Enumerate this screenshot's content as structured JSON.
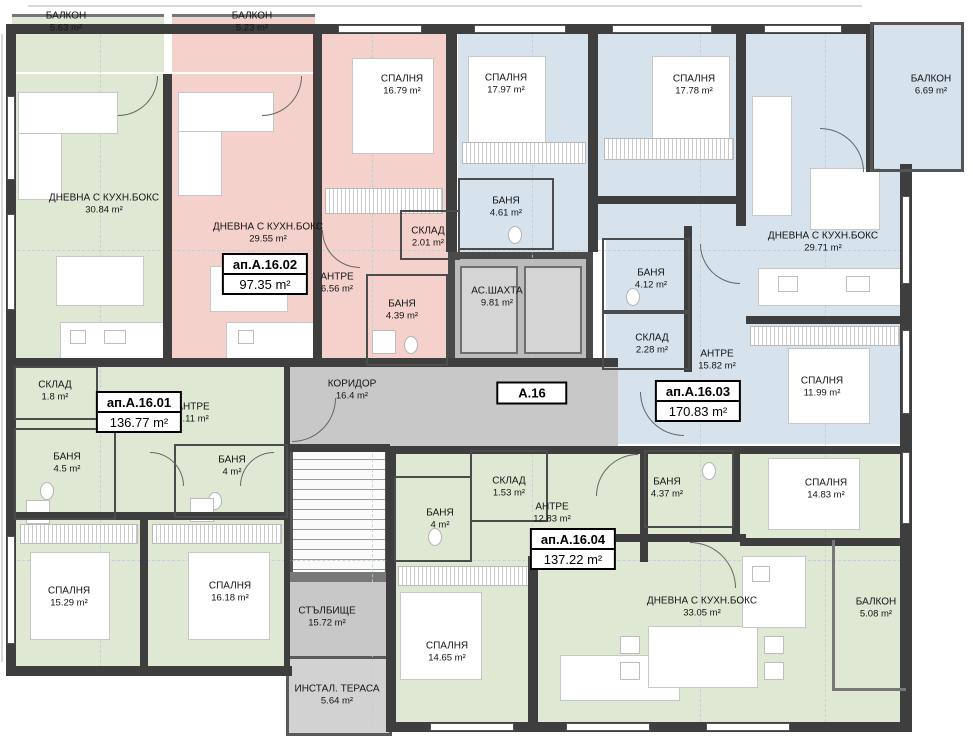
{
  "block": {
    "label": "А.16"
  },
  "units": [
    {
      "id": "ап.А.16.01",
      "area": "136.77 m²"
    },
    {
      "id": "ап.А.16.02",
      "area": "97.35 m²"
    },
    {
      "id": "ап.А.16.03",
      "area": "170.83 m²"
    },
    {
      "id": "ап.А.16.04",
      "area": "137.22 m²"
    }
  ],
  "rooms": [
    {
      "name": "БАЛКОН",
      "area": "5.63 m²",
      "unit": "ап.А.16.01"
    },
    {
      "name": "БАЛКОН",
      "area": "5.23 m²",
      "unit": "ап.А.16.02"
    },
    {
      "name": "ДНЕВНА С КУХН.БОКС",
      "area": "30.84 m²",
      "unit": "ап.А.16.01"
    },
    {
      "name": "ДНЕВНА С КУХН.БОКС",
      "area": "29.55 m²",
      "unit": "ап.А.16.02"
    },
    {
      "name": "СПАЛНЯ",
      "area": "16.79 m²",
      "unit": "ап.А.16.02"
    },
    {
      "name": "АНТРЕ",
      "area": "6.56 m²",
      "unit": "ап.А.16.02"
    },
    {
      "name": "СКЛАД",
      "area": "2.01 m²",
      "unit": "ап.А.16.02"
    },
    {
      "name": "БАНЯ",
      "area": "4.39 m²",
      "unit": "ап.А.16.02"
    },
    {
      "name": "СПАЛНЯ",
      "area": "17.97 m²",
      "unit": "ап.А.16.03"
    },
    {
      "name": "БАНЯ",
      "area": "4.61 m²",
      "unit": "ап.А.16.03"
    },
    {
      "name": "СПАЛНЯ",
      "area": "17.78 m²",
      "unit": "ап.А.16.03"
    },
    {
      "name": "ДНЕВНА С КУХН.БОКС",
      "area": "29.71 m²",
      "unit": "ап.А.16.03"
    },
    {
      "name": "БАЛКОН",
      "area": "6.69 m²",
      "unit": "ап.А.16.03"
    },
    {
      "name": "БАНЯ",
      "area": "4.12 m²",
      "unit": "ап.А.16.03"
    },
    {
      "name": "СКЛАД",
      "area": "2.28 m²",
      "unit": "ап.А.16.03"
    },
    {
      "name": "АНТРЕ",
      "area": "15.82 m²",
      "unit": "ап.А.16.03"
    },
    {
      "name": "СПАЛНЯ",
      "area": "11.99 m²",
      "unit": "ап.А.16.03"
    },
    {
      "name": "КОРИДОР",
      "area": "16.4 m²",
      "unit": "common"
    },
    {
      "name": "АС.ШАХТА",
      "area": "9.81 m²",
      "unit": "common"
    },
    {
      "name": "СКЛАД",
      "area": "1.8 m²",
      "unit": "ап.А.16.01"
    },
    {
      "name": "АНТРЕ",
      "area": "9.11 m²",
      "unit": "ап.А.16.01"
    },
    {
      "name": "БАНЯ",
      "area": "4.5 m²",
      "unit": "ап.А.16.01"
    },
    {
      "name": "БАНЯ",
      "area": "4 m²",
      "unit": "ап.А.16.01"
    },
    {
      "name": "СПАЛНЯ",
      "area": "15.29 m²",
      "unit": "ап.А.16.01"
    },
    {
      "name": "СПАЛНЯ",
      "area": "16.18 m²",
      "unit": "ап.А.16.01"
    },
    {
      "name": "СТЪЛБИЩЕ",
      "area": "15.72 m²",
      "unit": "common"
    },
    {
      "name": "ИНСТАЛ. ТЕРАСА",
      "area": "5.64 m²",
      "unit": "common"
    },
    {
      "name": "БАНЯ",
      "area": "4 m²",
      "unit": "ап.А.16.04"
    },
    {
      "name": "СКЛАД",
      "area": "1.53 m²",
      "unit": "ап.А.16.04"
    },
    {
      "name": "АНТРЕ",
      "area": "12.83 m²",
      "unit": "ап.А.16.04"
    },
    {
      "name": "БАНЯ",
      "area": "4.37 m²",
      "unit": "ап.А.16.04"
    },
    {
      "name": "СПАЛНЯ",
      "area": "14.83 m²",
      "unit": "ап.А.16.04"
    },
    {
      "name": "СПАЛНЯ",
      "area": "14.65 m²",
      "unit": "ап.А.16.04"
    },
    {
      "name": "ДНЕВНА С КУХН.БОКС",
      "area": "33.05 m²",
      "unit": "ап.А.16.04"
    },
    {
      "name": "БАЛКОН",
      "area": "5.08 m²",
      "unit": "ап.А.16.04"
    }
  ],
  "colors": {
    "unit_01_fill": "#dfe8d3",
    "unit_02_fill": "#f4d2cb",
    "unit_03_fill": "#d6e2ec",
    "unit_04_fill": "#dfe8d3",
    "common_fill": "#c8c8c8",
    "wall": "#3e3e3e"
  }
}
